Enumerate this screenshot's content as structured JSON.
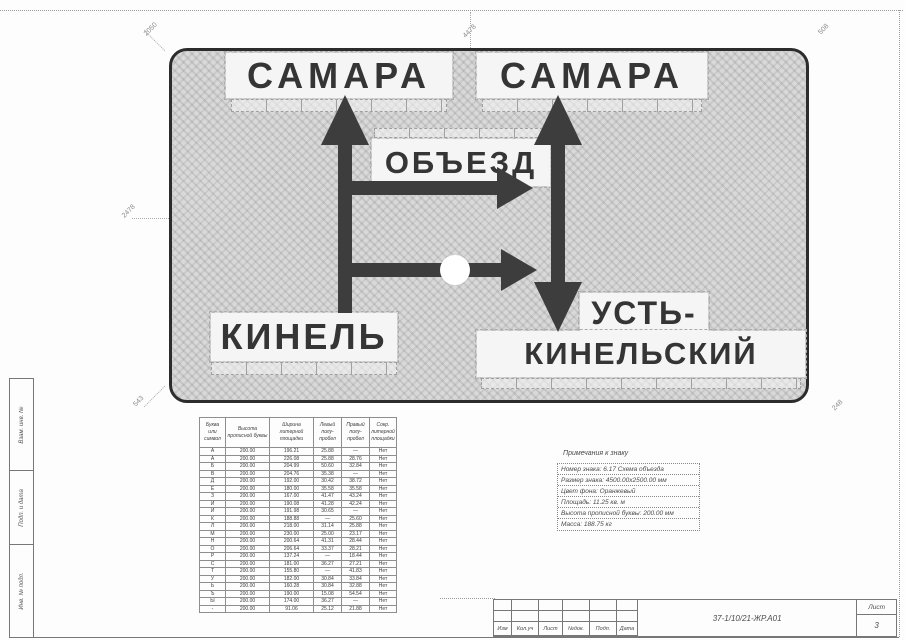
{
  "sign": {
    "words": {
      "top_left": "САМАРА",
      "top_right": "САМАРА",
      "detour": "ОБЪЕЗД",
      "bottom_left": "КИНЕЛЬ",
      "bottom_right_line1": "УСТЬ-",
      "bottom_right_line2": "КИНЕЛЬСКИЙ"
    },
    "colors": {
      "panel_fill": "#d9d9d9",
      "ink": "#353535"
    }
  },
  "dimensions": {
    "top": "4478",
    "top_left": "2050",
    "top_right": "508",
    "left": "2478",
    "bottom_left": "543",
    "bottom_right": "248"
  },
  "stamp": {
    "labels": [
      "Взам. инв. №",
      "Подп. и дата",
      "Инв. № подл."
    ]
  },
  "letter_table": {
    "headers": [
      "Буква или символ",
      "Высота прописной буквы",
      "Ширина литерной площадки",
      "Левый полу-пробел",
      "Правый полу-пробел",
      "Сокр. литерной площадки"
    ],
    "rows": [
      [
        "А",
        "200.00",
        "196.21",
        "25.88",
        "—",
        "Нет"
      ],
      [
        "А",
        "200.00",
        "226.08",
        "25.88",
        "28.76",
        "Нет"
      ],
      [
        "Б",
        "200.00",
        "204.99",
        "50.60",
        "32.84",
        "Нет"
      ],
      [
        "В",
        "200.00",
        "204.76",
        "35.38",
        "—",
        "Нет"
      ],
      [
        "Д",
        "200.00",
        "192.00",
        "30.42",
        "38.72",
        "Нет"
      ],
      [
        "Е",
        "200.00",
        "180.00",
        "35.58",
        "35.58",
        "Нет"
      ],
      [
        "З",
        "200.00",
        "167.00",
        "41.47",
        "43.24",
        "Нет"
      ],
      [
        "И",
        "200.00",
        "190.08",
        "41.28",
        "42.24",
        "Нет"
      ],
      [
        "Й",
        "200.00",
        "191.98",
        "30.65",
        "—",
        "Нет"
      ],
      [
        "К",
        "200.00",
        "188.88",
        "—",
        "25.60",
        "Нет"
      ],
      [
        "Л",
        "200.00",
        "218.00",
        "31.14",
        "25.88",
        "Нет"
      ],
      [
        "М",
        "200.00",
        "230.00",
        "25.00",
        "23.17",
        "Нет"
      ],
      [
        "Н",
        "200.00",
        "200.64",
        "41.31",
        "28.44",
        "Нет"
      ],
      [
        "О",
        "200.00",
        "206.64",
        "33.37",
        "28.21",
        "Нет"
      ],
      [
        "Р",
        "200.00",
        "137.24",
        "—",
        "18.44",
        "Нет"
      ],
      [
        "С",
        "200.00",
        "181.00",
        "36.27",
        "27.21",
        "Нет"
      ],
      [
        "Т",
        "200.00",
        "155.80",
        "—",
        "41.83",
        "Нет"
      ],
      [
        "У",
        "200.00",
        "182.00",
        "30.84",
        "33.84",
        "Нет"
      ],
      [
        "Ь",
        "200.00",
        "160.28",
        "30.84",
        "32.88",
        "Нет"
      ],
      [
        "Ъ",
        "200.00",
        "190.00",
        "15.08",
        "54.54",
        "Нет"
      ],
      [
        "Ы",
        "200.00",
        "174.00",
        "36.27",
        "—",
        "Нет"
      ],
      [
        "-",
        "200.00",
        "91.06",
        "25.12",
        "21.88",
        "Нет"
      ]
    ]
  },
  "notes": {
    "title": "Примечания к знаку",
    "lines": [
      "Номер знака: 6.17 Схема объезда",
      "Размер знака: 4500.00x2500.00 мм",
      "Цвет фона: Оранжевый",
      "Площадь: 11.25 кв. м",
      "Высота прописной буквы: 200.00 мм",
      "Масса: 188.75 кг"
    ]
  },
  "title_block": {
    "columns": [
      "Изм",
      "Кол.уч",
      "Лист",
      "№док.",
      "Подп.",
      "Дата"
    ],
    "doc_number": "37-1/10/21-ЖР.А01",
    "sheet_label": "Лист",
    "sheet_number": "3"
  }
}
